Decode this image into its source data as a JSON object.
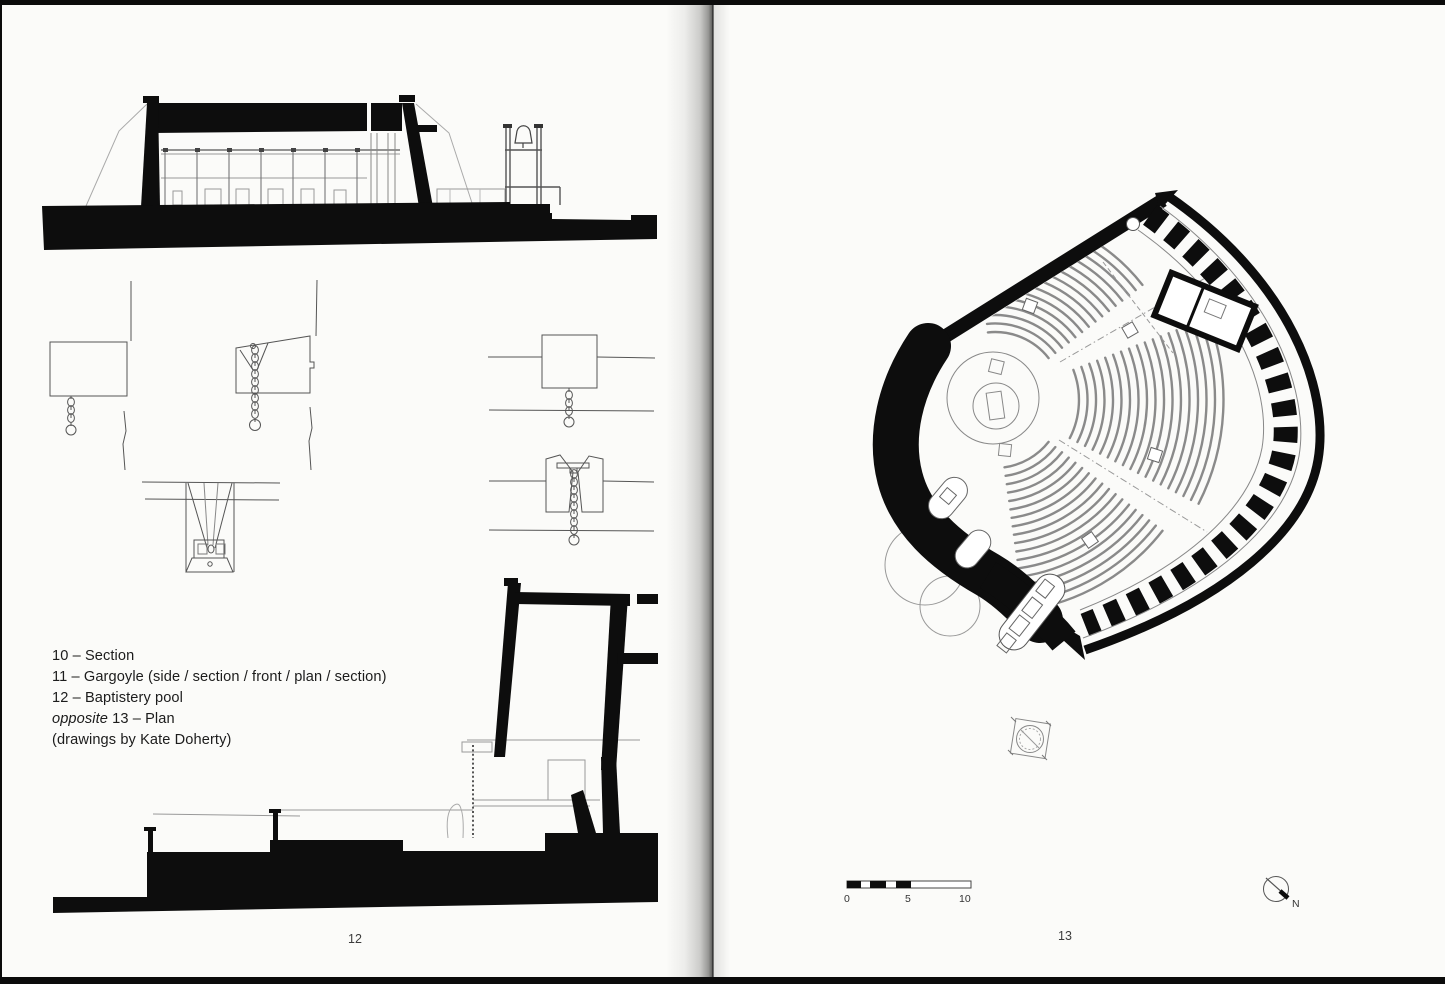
{
  "left_page": {
    "caption": {
      "line1": "10 – Section",
      "line2": "11 – Gargoyle (side / section / front / plan / section)",
      "line3": "12 – Baptistery pool",
      "line4_italic": "opposite",
      "line4_rest": " 13 – Plan",
      "line5": "(drawings by Kate Doherty)"
    },
    "page_number": "12"
  },
  "right_page": {
    "page_number": "13",
    "scale_bar": {
      "t0": "0",
      "t5": "5",
      "t10": "10"
    },
    "north_label": "N"
  },
  "colors": {
    "ink": "#0d0d0d",
    "fine_line": "#666666",
    "paper": "#fbfbf9"
  }
}
